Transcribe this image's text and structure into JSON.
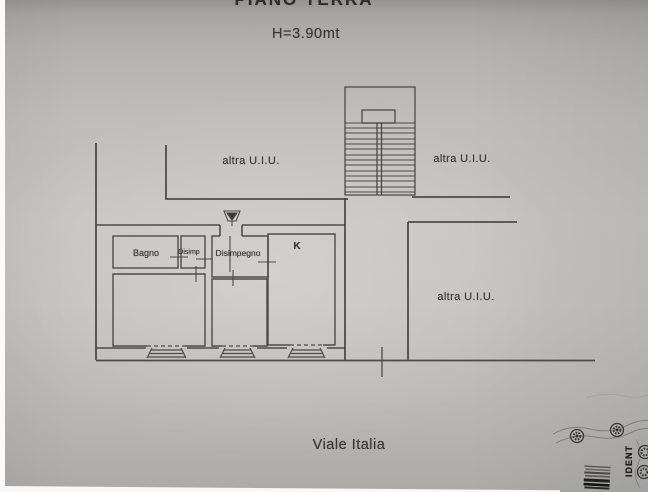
{
  "document": {
    "title": "PIANO TERRA",
    "height_label": "H=3.90mt",
    "street_label": "Viale Italia",
    "unit_labels": {
      "top_left": "altra U.I.U.",
      "top_right": "altra U.I.U.",
      "right": "altra U.I.U."
    },
    "rooms": {
      "bagno": "Bagno",
      "disimp": "Disimp",
      "disimpegno": "Disimpegno",
      "kitchen": "K"
    },
    "edge": {
      "vertical_text": "IDENT"
    },
    "colors": {
      "paper": "#c0beba",
      "wall_line": "#44413d",
      "text": "#3a3833",
      "barcode_dark": "#151412"
    }
  }
}
